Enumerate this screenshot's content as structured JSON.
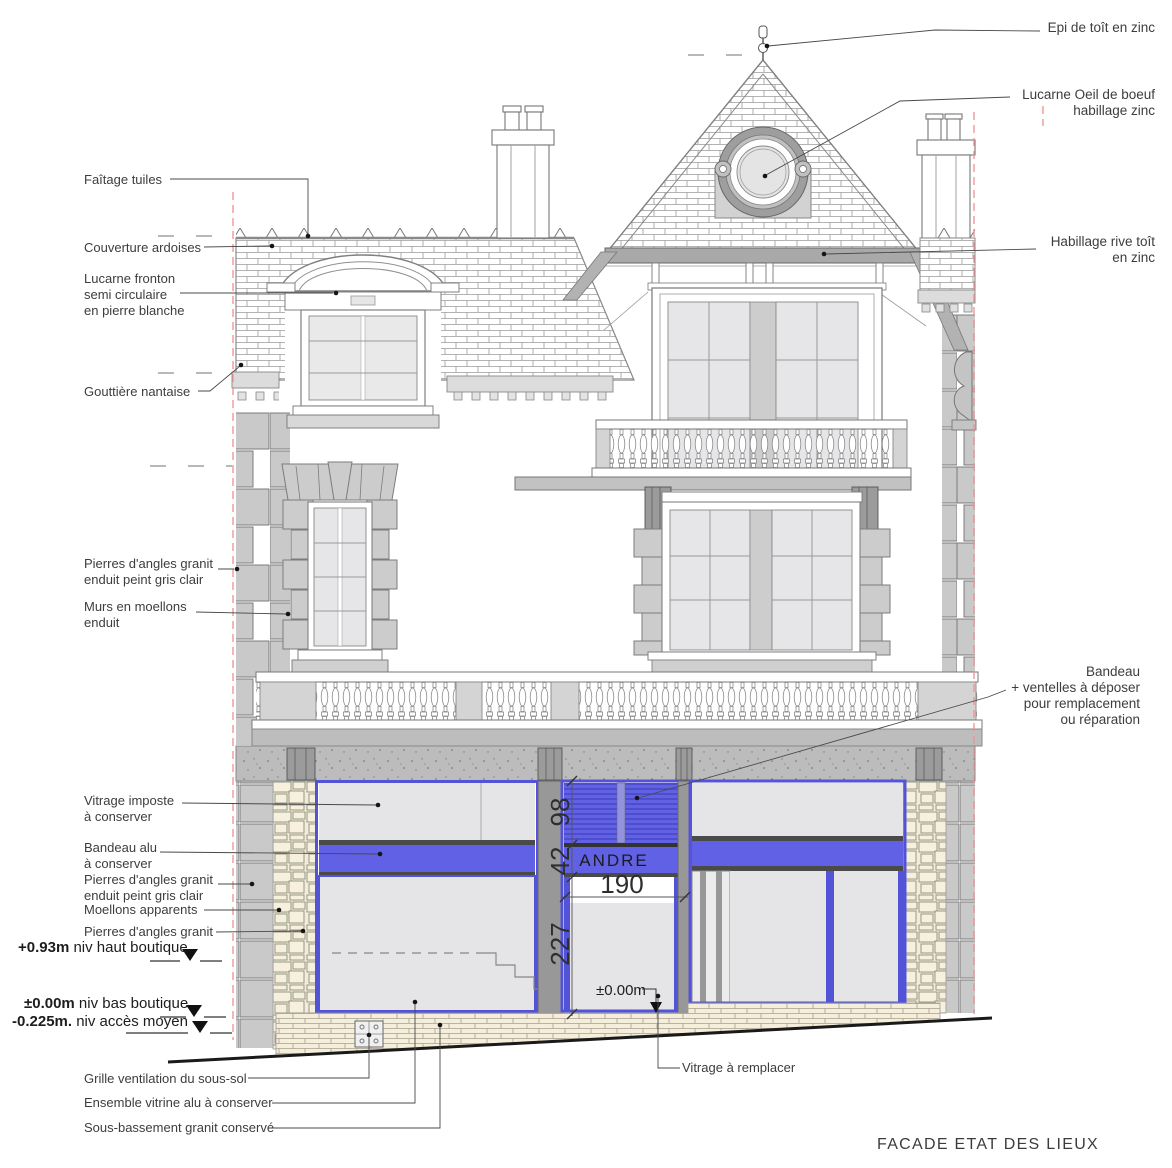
{
  "labels": {
    "faitage": "Faîtage tuiles",
    "couverture": "Couverture ardoises",
    "lucarne_fronton": [
      "Lucarne fronton",
      "semi circulaire",
      "en pierre blanche"
    ],
    "gouttiere": "Gouttière nantaise",
    "pierres_angles_gris": [
      "Pierres d'angles granit",
      "enduit peint gris clair"
    ],
    "murs_moellons": [
      "Murs en moellons",
      "enduit"
    ],
    "vitrage_imposte": [
      "Vitrage imposte",
      "à conserver"
    ],
    "bandeau_alu": [
      "Bandeau alu",
      "à conserver"
    ],
    "pierres_angles_gris2": [
      "Pierres d'angles granit",
      "enduit peint gris clair"
    ],
    "moellons_apparents": "Moellons apparents",
    "pierres_angles": "Pierres d'angles granit",
    "grille": "Grille ventilation du sous-sol",
    "vitrine": "Ensemble vitrine alu à conserver",
    "sous_bassement": "Sous-bassement granit conservé",
    "epi": "Epi de toît en zinc",
    "oeil": [
      "Lucarne Oeil de boeuf",
      "habillage zinc"
    ],
    "rive": [
      "Habillage rive toît",
      "en zinc"
    ],
    "ventelles": [
      "Bandeau",
      "+ ventelles à déposer",
      "pour remplacement",
      "ou réparation"
    ],
    "vitrage_remplacer": "Vitrage à remplacer"
  },
  "levels": [
    {
      "value": "+0.93m",
      "text": " niv haut boutique"
    },
    {
      "value": "±0.00m",
      "text": " niv bas boutique"
    },
    {
      "value": "-0.225m.",
      "text": " niv accès moyen"
    }
  ],
  "dimensions": {
    "d98": "98",
    "d42": "42",
    "d227": "227",
    "d190": "190",
    "zero": "±0.00m"
  },
  "sign": {
    "text": "ANDRE"
  },
  "footer": {
    "title": "FACADE ETAT DES LIEUX"
  },
  "colors": {
    "storefront_blue": "#6161e6",
    "frame_blue": "#5353d8",
    "stone_beige": "#f2ecd8",
    "guide_red": "#ef8f8f"
  }
}
